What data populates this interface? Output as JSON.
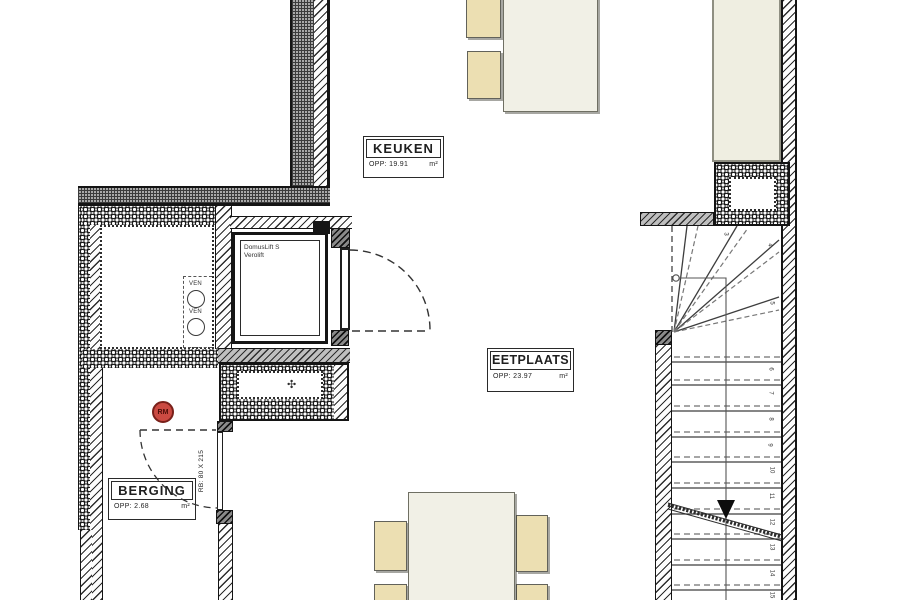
{
  "plan": {
    "rooms": {
      "keuken": {
        "name": "KEUKEN",
        "area_label": "OPP: 19.91",
        "area_unit": "m²"
      },
      "eetplaats": {
        "name": "EETPLAATS",
        "area_label": "OPP: 23.97",
        "area_unit": "m²"
      },
      "berging": {
        "name": "BERGING",
        "area_label": "OPP: 2.68",
        "area_unit": "m²"
      }
    },
    "lift": {
      "line1": "DomusLift S",
      "line2": "Verolift"
    },
    "vent_label": "VEN",
    "smoke_detector": {
      "label": "RM"
    },
    "door": {
      "label": "RB: 80 X 215"
    },
    "fan_symbol": "✣",
    "stairs": {
      "direction": "down",
      "step_numbers": [
        "3",
        "4",
        "5",
        "6",
        "7",
        "8",
        "9",
        "10",
        "11",
        "12",
        "13",
        "14",
        "15"
      ]
    }
  },
  "colors": {
    "wall_line": "#1f1f1f",
    "gray_wall": "#bfbfbf",
    "chair_fill": "#ecdfb2",
    "table_fill": "#f1f0e6",
    "counter_fill": "#efeee1",
    "smoke_detector_red": "#cb4a42"
  }
}
